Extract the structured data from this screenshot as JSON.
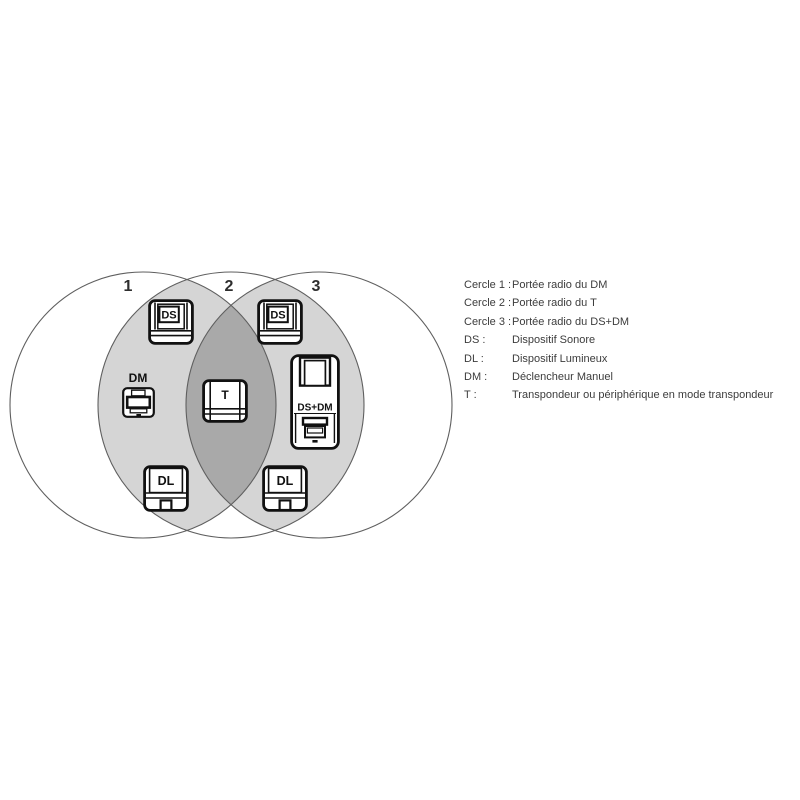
{
  "diagram": {
    "circle_labels": [
      "1",
      "2",
      "3"
    ],
    "colors": {
      "overlap_light": "#d5d5d5",
      "overlap_dark": "#a9a9a9",
      "circle_outline": "#5f5f5f"
    },
    "devices": {
      "ds_left": "DS",
      "ds_right": "DS",
      "dm": "DM",
      "t": "T",
      "ds_dm": "DS+DM",
      "dl_left": "DL",
      "dl_right": "DL"
    }
  },
  "legend": {
    "rows": [
      {
        "term": "Cercle 1 :",
        "def": "Portée radio du DM"
      },
      {
        "term": "Cercle 2 :",
        "def": "Portée radio du T"
      },
      {
        "term": "Cercle 3 :",
        "def": "Portée radio du DS+DM"
      },
      {
        "term": "DS :",
        "def": "Dispositif Sonore"
      },
      {
        "term": "DL :",
        "def": "Dispositif Lumineux"
      },
      {
        "term": "DM :",
        "def": "Déclencheur Manuel"
      },
      {
        "term": "T :",
        "def": "Transpondeur ou périphérique en mode transpondeur"
      }
    ]
  }
}
